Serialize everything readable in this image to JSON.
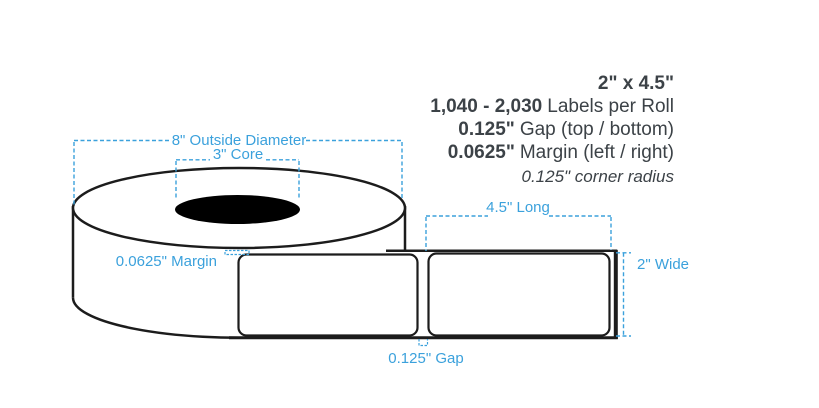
{
  "specs": {
    "size": "2\" x 4.5\"",
    "count_value": "1,040 - 2,030",
    "count_label": "Labels per Roll",
    "gap_value": "0.125\"",
    "gap_label": "Gap (top / bottom)",
    "margin_value": "0.0625\"",
    "margin_label": "Margin (left / right)",
    "corner_radius": "0.125\" corner radius"
  },
  "dimensions": {
    "outside_diameter": "8\" Outside Diameter",
    "core": "3\" Core",
    "margin": "0.0625\" Margin",
    "long": "4.5\" Long",
    "wide": "2\" Wide",
    "gap": "0.125\" Gap"
  },
  "colors": {
    "annotation_blue": "#3ba1dc",
    "line_black": "#1c1c1c",
    "text_dark": "#3c4247",
    "core_fill": "#000000",
    "background": "#ffffff"
  }
}
